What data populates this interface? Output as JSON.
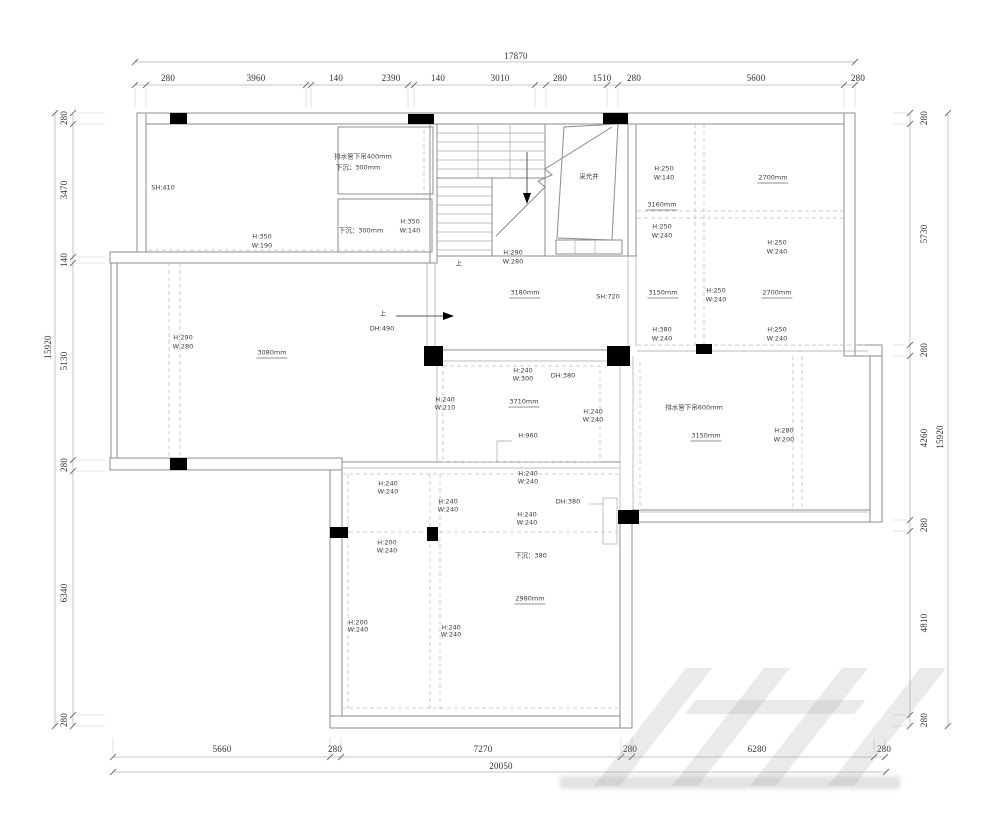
{
  "drawing": {
    "type": "floor-plan-ceiling-layout",
    "units": "mm",
    "dimensions": {
      "top": {
        "total": "17870",
        "segments": [
          {
            "t": "280",
            "x": 168
          },
          {
            "t": "3960",
            "x": 256
          },
          {
            "t": "140",
            "x": 336
          },
          {
            "t": "2390",
            "x": 391
          },
          {
            "t": "140",
            "x": 438
          },
          {
            "t": "3010",
            "x": 500
          },
          {
            "t": "280",
            "x": 560
          },
          {
            "t": "1510",
            "x": 602
          },
          {
            "t": "280",
            "x": 634
          },
          {
            "t": "5600",
            "x": 756
          },
          {
            "t": "280",
            "x": 858
          }
        ]
      },
      "bottom": {
        "total": "20050",
        "segments": [
          {
            "t": "5660",
            "x": 222
          },
          {
            "t": "280",
            "x": 335
          },
          {
            "t": "7270",
            "x": 483
          },
          {
            "t": "280",
            "x": 630
          },
          {
            "t": "6280",
            "x": 757
          },
          {
            "t": "280",
            "x": 884
          }
        ]
      },
      "left": {
        "total": "15920",
        "segments": [
          {
            "t": "280",
            "y": 118
          },
          {
            "t": "3470",
            "y": 190
          },
          {
            "t": "140",
            "y": 260
          },
          {
            "t": "5130",
            "y": 361
          },
          {
            "t": "280",
            "y": 465
          },
          {
            "t": "6340",
            "y": 593
          },
          {
            "t": "280",
            "y": 720
          }
        ]
      },
      "right": {
        "total": "15920",
        "segments": [
          {
            "t": "280",
            "y": 118
          },
          {
            "t": "5730",
            "y": 234
          },
          {
            "t": "280",
            "y": 350
          },
          {
            "t": "4260",
            "y": 438
          },
          {
            "t": "280",
            "y": 525
          },
          {
            "t": "4810",
            "y": 623
          },
          {
            "t": "280",
            "y": 720
          }
        ]
      }
    },
    "annotations": [
      {
        "t": "SH:410",
        "x": 163,
        "y": 188
      },
      {
        "t": "H:350",
        "x": 262,
        "y": 237
      },
      {
        "t": "W:190",
        "x": 262,
        "y": 246
      },
      {
        "t": "排水管下吊400mm",
        "x": 363,
        "y": 157
      },
      {
        "t": "下沉：300mm",
        "x": 358,
        "y": 168
      },
      {
        "t": "下沉：300mm",
        "x": 361,
        "y": 231
      },
      {
        "t": "H:350",
        "x": 410,
        "y": 222
      },
      {
        "t": "W:140",
        "x": 410,
        "y": 231
      },
      {
        "t": "H:290",
        "x": 513,
        "y": 253
      },
      {
        "t": "W:280",
        "x": 513,
        "y": 262
      },
      {
        "t": "上",
        "x": 459,
        "y": 264
      },
      {
        "t": "采光井",
        "x": 589,
        "y": 177
      },
      {
        "t": "H:250",
        "x": 664,
        "y": 169
      },
      {
        "t": "W:140",
        "x": 664,
        "y": 178
      },
      {
        "t": "2700mm",
        "x": 773,
        "y": 179,
        "k": "mm"
      },
      {
        "t": "3160mm",
        "x": 662,
        "y": 206,
        "k": "mm"
      },
      {
        "t": "H:250",
        "x": 662,
        "y": 227
      },
      {
        "t": "W:240",
        "x": 662,
        "y": 236
      },
      {
        "t": "H:250",
        "x": 777,
        "y": 243
      },
      {
        "t": "W:240",
        "x": 777,
        "y": 252
      },
      {
        "t": "3180mm",
        "x": 525,
        "y": 294,
        "k": "mm"
      },
      {
        "t": "SH:720",
        "x": 608,
        "y": 297
      },
      {
        "t": "3150mm",
        "x": 663,
        "y": 294,
        "k": "mm"
      },
      {
        "t": "H:250",
        "x": 716,
        "y": 291
      },
      {
        "t": "W:240",
        "x": 716,
        "y": 300
      },
      {
        "t": "2700mm",
        "x": 777,
        "y": 294,
        "k": "mm"
      },
      {
        "t": "H:380",
        "x": 662,
        "y": 330
      },
      {
        "t": "W:240",
        "x": 662,
        "y": 339
      },
      {
        "t": "H:250",
        "x": 777,
        "y": 330
      },
      {
        "t": "W:240",
        "x": 777,
        "y": 339
      },
      {
        "t": "上",
        "x": 383,
        "y": 314
      },
      {
        "t": "DH:490",
        "x": 382,
        "y": 329
      },
      {
        "t": "H:290",
        "x": 183,
        "y": 338
      },
      {
        "t": "W:280",
        "x": 183,
        "y": 347
      },
      {
        "t": "3080mm",
        "x": 272,
        "y": 354,
        "k": "mm"
      },
      {
        "t": "H:240",
        "x": 523,
        "y": 371
      },
      {
        "t": "W:300",
        "x": 523,
        "y": 379
      },
      {
        "t": "DH:380",
        "x": 563,
        "y": 376
      },
      {
        "t": "H:240",
        "x": 445,
        "y": 400
      },
      {
        "t": "W:210",
        "x": 445,
        "y": 408
      },
      {
        "t": "3710mm",
        "x": 524,
        "y": 403,
        "k": "mm"
      },
      {
        "t": "H:240",
        "x": 593,
        "y": 412
      },
      {
        "t": "W:240",
        "x": 593,
        "y": 420
      },
      {
        "t": "H:960",
        "x": 528,
        "y": 436
      },
      {
        "t": "排水管下吊600mm",
        "x": 694,
        "y": 408
      },
      {
        "t": "3150mm",
        "x": 706,
        "y": 437,
        "k": "mm"
      },
      {
        "t": "H:280",
        "x": 784,
        "y": 431
      },
      {
        "t": "W:200",
        "x": 784,
        "y": 440
      },
      {
        "t": "H:240",
        "x": 528,
        "y": 474
      },
      {
        "t": "W:240",
        "x": 528,
        "y": 482
      },
      {
        "t": "H:240",
        "x": 388,
        "y": 484
      },
      {
        "t": "W:240",
        "x": 388,
        "y": 492
      },
      {
        "t": "H:240",
        "x": 448,
        "y": 502
      },
      {
        "t": "W:240",
        "x": 448,
        "y": 510
      },
      {
        "t": "DH:380",
        "x": 568,
        "y": 502
      },
      {
        "t": "H:240",
        "x": 527,
        "y": 515
      },
      {
        "t": "W:240",
        "x": 527,
        "y": 523
      },
      {
        "t": "H:200",
        "x": 387,
        "y": 543
      },
      {
        "t": "W:240",
        "x": 387,
        "y": 551
      },
      {
        "t": "下沉：380",
        "x": 531,
        "y": 556
      },
      {
        "t": "2980mm",
        "x": 530,
        "y": 600,
        "k": "mm"
      },
      {
        "t": "H:200",
        "x": 358,
        "y": 623
      },
      {
        "t": "W:240",
        "x": 358,
        "y": 630
      },
      {
        "t": "H:240",
        "x": 451,
        "y": 628
      },
      {
        "t": "W:240",
        "x": 451,
        "y": 635
      }
    ],
    "colors": {
      "wall": "#8d8d8d",
      "column": "#000000",
      "dashed": "#bfbfbf",
      "text": "#3c3c3c",
      "dim_text": "#2f2f2f"
    }
  }
}
